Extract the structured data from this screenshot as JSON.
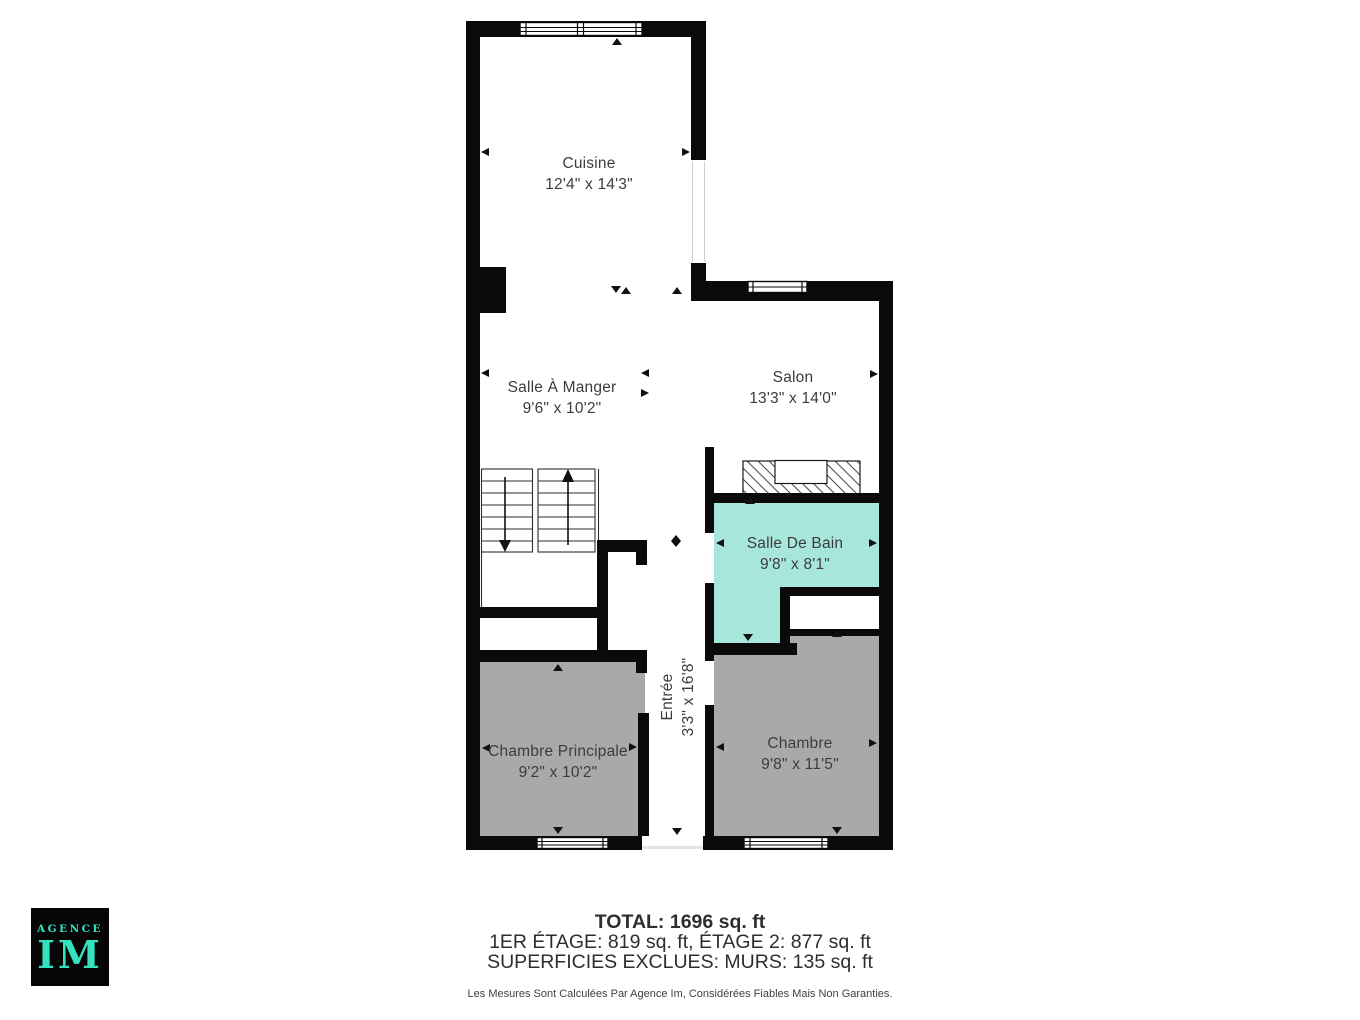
{
  "rooms": [
    {
      "name": "Cuisine",
      "dims": "12'4\" x 14'3\""
    },
    {
      "name": "Salle À Manger",
      "dims": "9'6\" x 10'2\""
    },
    {
      "name": "Salon",
      "dims": "13'3\" x 14'0\""
    },
    {
      "name": "Salle De Bain",
      "dims": "9'8\" x 8'1\""
    },
    {
      "name": "Chambre Principale",
      "dims": "9'2\" x 10'2\""
    },
    {
      "name": "Chambre",
      "dims": "9'8\" x 11'5\""
    },
    {
      "name": "Entrée",
      "dims": "3'3\" x 16'8\""
    }
  ],
  "summary": {
    "total": "TOTAL: 1696 sq. ft",
    "floors": "1ER ÉTAGE: 819 sq. ft, ÉTAGE 2: 877 sq. ft",
    "exclusions": "SUPERFICIES EXCLUES: MURS: 135 sq. ft",
    "disclaimer": "Les Mesures Sont Calculées Par Agence Im, Considérées Fiables Mais Non Garanties."
  },
  "logo": {
    "agency": "AGENCE",
    "initials": "IM"
  },
  "colors": {
    "wall": "#0a0a0a",
    "bathroom_fill": "#a7e6db",
    "bedroom_fill": "#a9a9a9",
    "logo_background": "#050505",
    "logo_text": "#35e2be",
    "label_text": "#3c3c3c"
  }
}
